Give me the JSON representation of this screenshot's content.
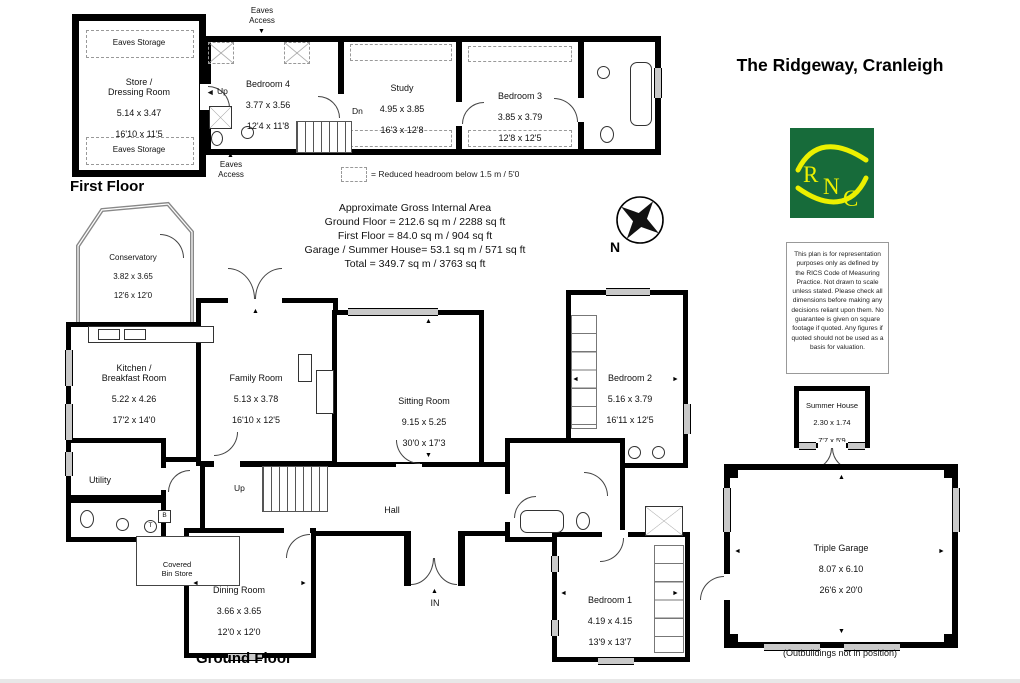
{
  "title": "The Ridgeway, Cranleigh",
  "logo": {
    "letters": [
      "R",
      "N",
      "C"
    ],
    "bg_color": "#176b3a",
    "fg_color": "#ecf000"
  },
  "labels": {
    "first_floor": "First Floor",
    "ground_floor": "Ground Floor",
    "eaves_storage": "Eaves Storage",
    "eaves_access": "Eaves\nAccess",
    "up": "Up",
    "dn": "Dn",
    "in": "IN",
    "tank": "T",
    "boiler": "B"
  },
  "icons": {
    "up_arrow": "▲",
    "down_arrow": "▼",
    "left_arrow": "◄",
    "right_arrow": "►"
  },
  "rooms": {
    "store": {
      "name": "Store /\nDressing Room",
      "metric": "5.14 x 3.47",
      "imperial": "16'10 x 11'5"
    },
    "bedroom4": {
      "name": "Bedroom 4",
      "metric": "3.77 x 3.56",
      "imperial": "12'4 x 11'8"
    },
    "study": {
      "name": "Study",
      "metric": "4.95 x 3.85",
      "imperial": "16'3 x 12'8"
    },
    "bedroom3": {
      "name": "Bedroom 3",
      "metric": "3.85 x 3.79",
      "imperial": "12'8 x 12'5"
    },
    "conservatory": {
      "name": "Conservatory",
      "metric": "3.82 x 3.65",
      "imperial": "12'6 x 12'0"
    },
    "kitchen": {
      "name": "Kitchen /\nBreakfast Room",
      "metric": "5.22 x 4.26",
      "imperial": "17'2 x 14'0"
    },
    "family": {
      "name": "Family Room",
      "metric": "5.13 x 3.78",
      "imperial": "16'10 x 12'5"
    },
    "sitting": {
      "name": "Sitting Room",
      "metric": "9.15 x 5.25",
      "imperial": "30'0 x 17'3"
    },
    "bedroom2": {
      "name": "Bedroom 2",
      "metric": "5.16 x 3.79",
      "imperial": "16'11 x 12'5"
    },
    "hall": {
      "name": "Hall"
    },
    "utility": {
      "name": "Utility"
    },
    "bin_store": {
      "name": "Covered\nBin Store"
    },
    "dining": {
      "name": "Dining Room",
      "metric": "3.66 x 3.65",
      "imperial": "12'0 x 12'0"
    },
    "bedroom1": {
      "name": "Bedroom 1",
      "metric": "4.19 x 4.15",
      "imperial": "13'9 x 13'7"
    },
    "summer_house": {
      "name": "Summer House",
      "metric": "2.30 x 1.74",
      "imperial": "7'7 x 5'9"
    },
    "garage": {
      "name": "Triple Garage",
      "metric": "8.07 x 6.10",
      "imperial": "26'6 x 20'0"
    }
  },
  "legend": {
    "text": "= Reduced headroom below 1.5 m / 5'0"
  },
  "areas": {
    "heading": "Approximate Gross Internal Area",
    "lines": [
      "Ground Floor = 212.6 sq m / 2288 sq ft",
      "First Floor = 84.0 sq m / 904 sq ft",
      "Garage / Summer House= 53.1 sq m / 571 sq ft",
      "Total = 349.7 sq m / 3763 sq ft"
    ]
  },
  "compass": {
    "label": "N"
  },
  "disclaimer": "This plan is for representation purposes only as defined by the RICS Code of Measuring Practice. Not drawn to scale unless stated. Please check all dimensions before making any decisions reliant upon them. No guarantee is given on square footage if quoted. Any figures if quoted should not be used as a basis for valuation.",
  "outbuildings_note": "(Outbuildings not in position)",
  "colors": {
    "wall": "#000000",
    "window": "#c9c9c9"
  }
}
